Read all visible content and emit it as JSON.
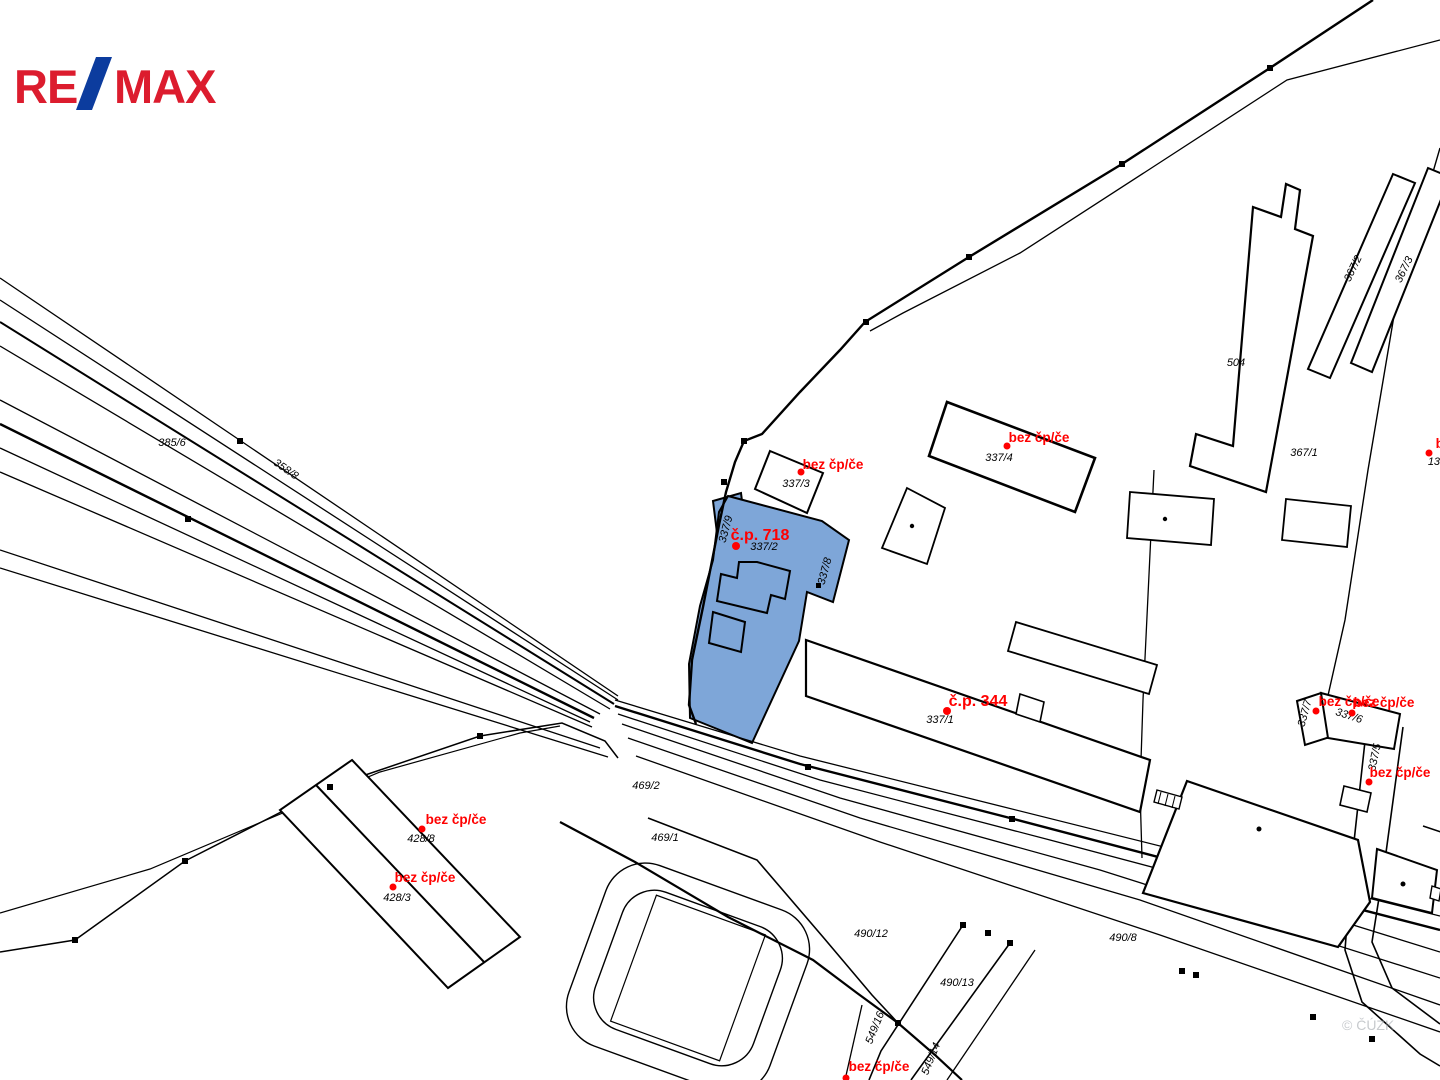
{
  "logo": {
    "re": "RE",
    "slash": "/",
    "max": "MAX",
    "red": "#DC1C2E",
    "blue": "#0C3C9E"
  },
  "map": {
    "background": "#ffffff",
    "line_color": "#000000",
    "highlight_fill": "#7EA6D8",
    "red_label_color": "#FF0000",
    "black_label_color": "#000000",
    "watermark": {
      "text": "© ČÚZK",
      "color": "#9aa0a6"
    },
    "highlight_parcels": [
      {
        "name": "337/2 (č.p. 718)"
      },
      {
        "name": "337/9"
      }
    ],
    "parcel_labels": [
      {
        "text": "385/6"
      },
      {
        "text": "358/8"
      },
      {
        "text": "337/3"
      },
      {
        "text": "337/2"
      },
      {
        "text": "337/9"
      },
      {
        "text": "337/8"
      },
      {
        "text": "337/4"
      },
      {
        "text": "504"
      },
      {
        "text": "367/2"
      },
      {
        "text": "367/3"
      },
      {
        "text": "367/1"
      },
      {
        "text": "337/1"
      },
      {
        "text": "337/6"
      },
      {
        "text": "337/7"
      },
      {
        "text": "337/5"
      },
      {
        "text": "469/2"
      },
      {
        "text": "469/1"
      },
      {
        "text": "428/8"
      },
      {
        "text": "428/3"
      },
      {
        "text": "490/12"
      },
      {
        "text": "490/13"
      },
      {
        "text": "490/8"
      },
      {
        "text": "549/16"
      },
      {
        "text": "549/14"
      },
      {
        "text": "134"
      }
    ],
    "red_labels": [
      {
        "text": "bez čp/če"
      },
      {
        "text": "č.p. 718"
      },
      {
        "text": "bez čp/če"
      },
      {
        "text": "č.p. 344"
      },
      {
        "text": "bez čp/če"
      },
      {
        "text": "bez čp/če"
      },
      {
        "text": "bez čp/če"
      },
      {
        "text": "bez čp/če"
      },
      {
        "text": "bez čp/če"
      },
      {
        "text": "bez čp/če"
      },
      {
        "text": "bez čp/če"
      }
    ]
  }
}
